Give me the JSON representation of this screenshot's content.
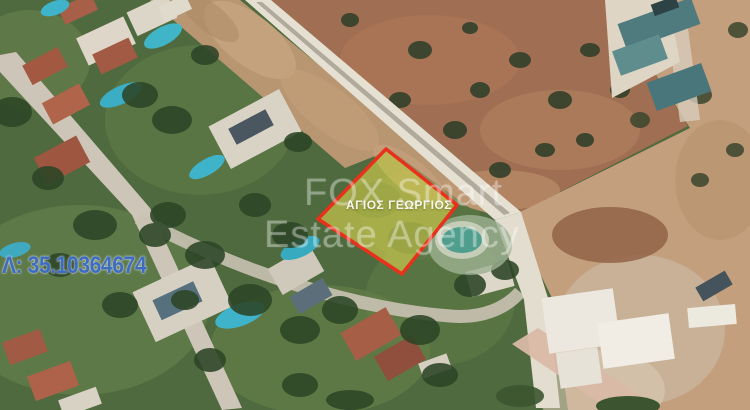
{
  "overlays": {
    "watermark": {
      "line1": "FOX Smart",
      "line2": "Estate Agency"
    },
    "plot": {
      "label": "ΑΓΙΟΣ ΓΕΩΡΓΙΟΣ"
    },
    "coordinates": {
      "latitude_label": "Λ: 35.10364674"
    }
  },
  "colors": {
    "plot_fill": "#d8d24f",
    "plot_border": "#e8311c",
    "coordinate_text": "#3e6cc0",
    "watermark_text": "#ffffff",
    "pool_water": "#3fb3c9",
    "terracotta_roof": "#a85f47",
    "warehouse_teal": "#4f7a7e"
  }
}
